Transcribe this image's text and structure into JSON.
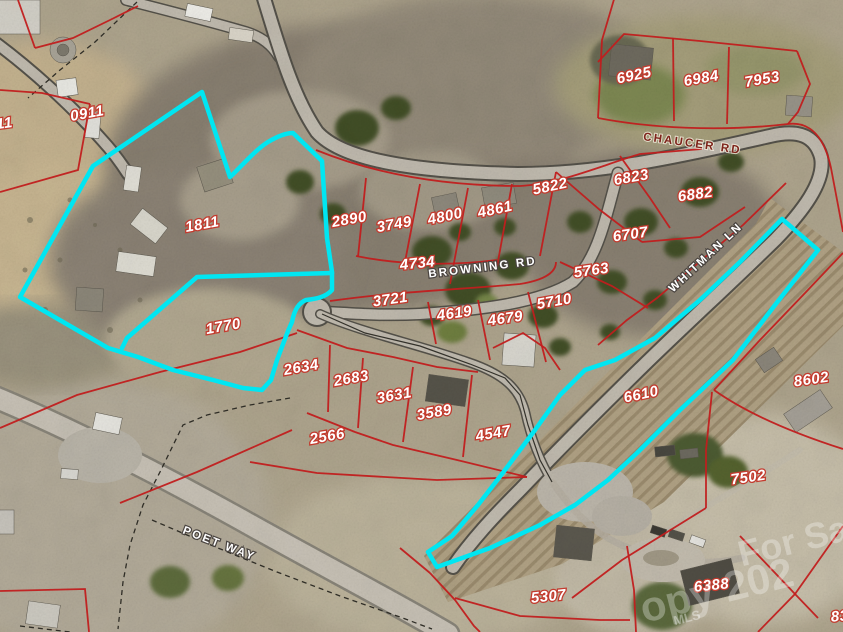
{
  "colors": {
    "highlight": "#00e6f2",
    "parcel_line": "#c11e1e",
    "parcel_label_fill": "#ffffff",
    "parcel_label_stroke": "#c33b2e",
    "road_label_fill": "#ffffff"
  },
  "roads": [
    {
      "name": "CHAUCER RD"
    },
    {
      "name": "BROWNING RD"
    },
    {
      "name": "WHITMAN LN"
    },
    {
      "name": "POET WAY"
    }
  ],
  "parcels": [
    {
      "id": "0911"
    },
    {
      "id": "11"
    },
    {
      "id": "1811"
    },
    {
      "id": "1770"
    },
    {
      "id": "2890"
    },
    {
      "id": "3749"
    },
    {
      "id": "4800"
    },
    {
      "id": "4861"
    },
    {
      "id": "5822"
    },
    {
      "id": "6823"
    },
    {
      "id": "6882"
    },
    {
      "id": "6707"
    },
    {
      "id": "5763"
    },
    {
      "id": "4734"
    },
    {
      "id": "3721"
    },
    {
      "id": "4619"
    },
    {
      "id": "4679"
    },
    {
      "id": "5710"
    },
    {
      "id": "2634"
    },
    {
      "id": "2683"
    },
    {
      "id": "3631"
    },
    {
      "id": "3589"
    },
    {
      "id": "2566"
    },
    {
      "id": "4547"
    },
    {
      "id": "6610"
    },
    {
      "id": "8602"
    },
    {
      "id": "7502"
    },
    {
      "id": "6388"
    },
    {
      "id": "5307"
    },
    {
      "id": "6925"
    },
    {
      "id": "6984"
    },
    {
      "id": "7953"
    },
    {
      "id": "83"
    }
  ],
  "watermark": {
    "line1": "For Sa",
    "line2": "opy 202",
    "line3": "MLS"
  }
}
